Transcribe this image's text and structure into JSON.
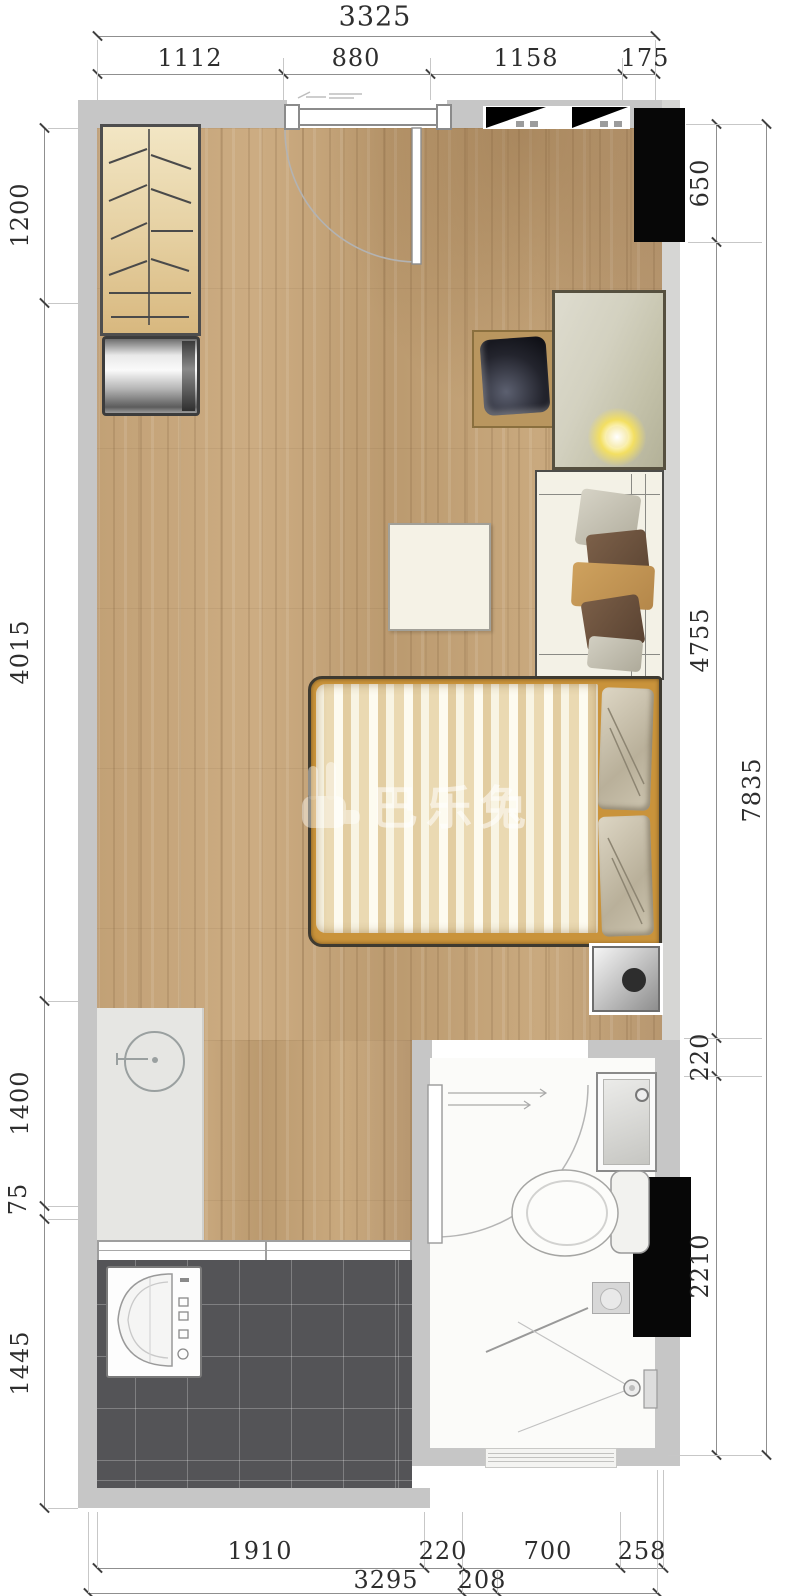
{
  "title": "apartment-floor-plan",
  "watermark": {
    "text": "巴乐兔"
  },
  "dimensions": {
    "top_total": "3325",
    "top_segments": [
      "1112",
      "880",
      "1158",
      "175"
    ],
    "left": [
      "1200",
      "4015",
      "1400",
      "75",
      "1445"
    ],
    "right": [
      "650",
      "4755",
      "220",
      "2210"
    ],
    "right_total": "7835",
    "bottom_row1": [
      "1910",
      "220",
      "700",
      "258"
    ],
    "bottom_row2": [
      "3295",
      "208"
    ]
  },
  "colors": {
    "wall": "#c6c6c6",
    "wood_floor": "#c5a57a",
    "balcony_tile": "#545457",
    "bath_floor": "#fbfbf9",
    "shaft_black": "#070707",
    "bed_frame_accent": "#c9933b",
    "watermark": "rgba(255,255,255,0.55)"
  }
}
